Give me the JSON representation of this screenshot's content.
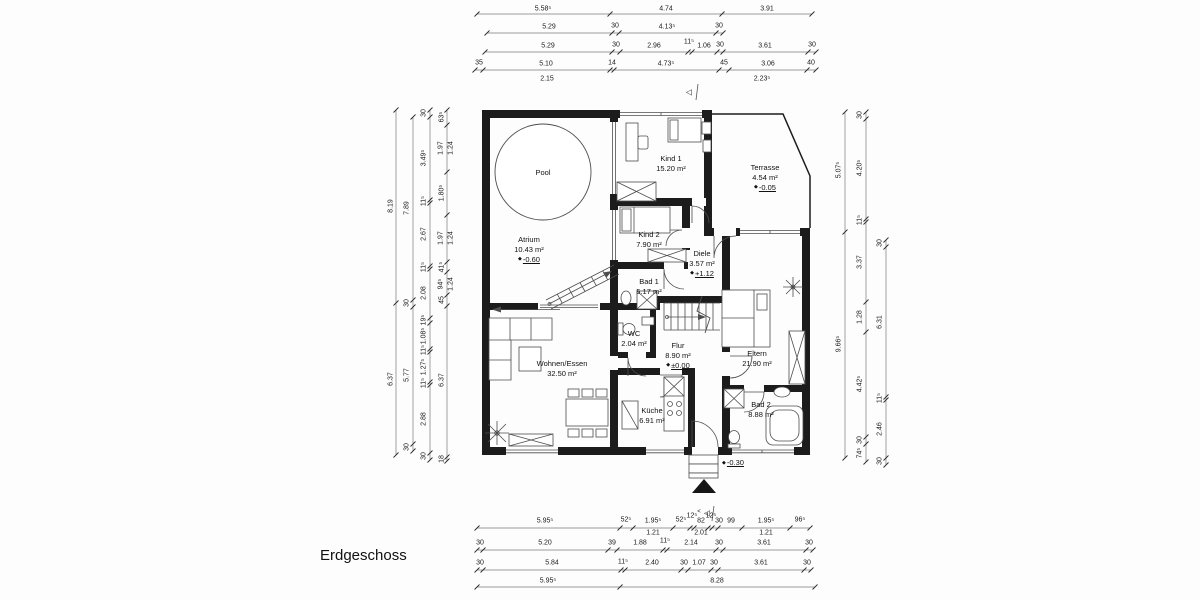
{
  "title": "Erdgeschoss",
  "icons": {
    "level_marker": "◆",
    "section_marker": "◁",
    "section_marker_small": "<"
  },
  "rooms": {
    "pool": {
      "name": "Pool"
    },
    "atrium": {
      "name": "Atrium",
      "area": "10.43 m²",
      "level": "-0.60"
    },
    "kind1": {
      "name": "Kind 1",
      "area": "15.20 m²"
    },
    "kind2": {
      "name": "Kind 2",
      "area": "7.90 m²"
    },
    "terrasse": {
      "name": "Terrasse",
      "area": "4.54 m²",
      "level": "-0.05"
    },
    "diele": {
      "name": "Diele",
      "area": "3.57 m²",
      "level": "+1.12"
    },
    "bad1": {
      "name": "Bad 1",
      "area": "5.17 m²"
    },
    "wc": {
      "name": "WC",
      "area": "2.04 m²"
    },
    "flur": {
      "name": "Flur",
      "area": "8.90 m²",
      "level": "±0.00"
    },
    "eltern": {
      "name": "Eltern",
      "area": "21.90 m²"
    },
    "wohnen": {
      "name": "Wohnen/Essen",
      "area": "32.50 m²"
    },
    "kueche": {
      "name": "Küche",
      "area": "6.91 m²"
    },
    "bad2": {
      "name": "Bad 2",
      "area": "8.88 m²"
    }
  },
  "outside": {
    "level": "-0.30"
  },
  "dims": {
    "t1": [
      "5.58⁵",
      "4.74",
      "3.91"
    ],
    "t2": [
      "5.29",
      "30",
      "4.13⁵",
      "30"
    ],
    "t3": [
      "5.29",
      "30",
      "2.96",
      "11⁵",
      "1.06",
      "30",
      "3.61",
      "30"
    ],
    "t4": [
      "35",
      "5.10",
      "14",
      "4.73⁵",
      "45",
      "3.06",
      "40"
    ],
    "t5": [
      "2.15",
      "2.23⁵"
    ],
    "b1": [
      "5.95⁵",
      "52⁵",
      "1.95⁵",
      "52⁵",
      "12⁵",
      "82",
      "12⁵",
      "30",
      "99",
      "1.95⁵",
      "96⁵"
    ],
    "b1sub": [
      "1.21",
      "2.01",
      "1.21"
    ],
    "b2": [
      "30",
      "5.20",
      "39",
      "1.88",
      "11⁵",
      "2.14",
      "30",
      "3.61",
      "30"
    ],
    "b3": [
      "30",
      "5.84",
      "11⁵",
      "2.40",
      "30",
      "1.07",
      "30",
      "3.61",
      "30"
    ],
    "b4": [
      "5.95⁵",
      "8.28"
    ],
    "l1": [
      "8.19",
      "6.37"
    ],
    "l2": [
      "7.89",
      "30",
      "5.77",
      "30"
    ],
    "l3": [
      "30",
      "3.49⁵",
      "11⁵",
      "2.67",
      "11⁵",
      "2.08",
      "19⁵",
      "1.08⁵",
      "11⁵",
      "1.27⁵",
      "11⁵",
      "2.88",
      "30"
    ],
    "l4": [
      "63⁵",
      "1.97",
      "1.24",
      "1.80⁵",
      "1.97",
      "1.24",
      "41⁵",
      "94⁵",
      "1.24",
      "45",
      "6.37",
      "18"
    ],
    "r1": [
      "5.07⁵",
      "9.66⁵"
    ],
    "r2": [
      "30",
      "4.20⁵",
      "11⁵",
      "3.37",
      "1.28",
      "4.42⁵",
      "30",
      "74⁵"
    ],
    "r3": [
      "30",
      "6.31",
      "11⁵",
      "2.46",
      "30"
    ]
  }
}
